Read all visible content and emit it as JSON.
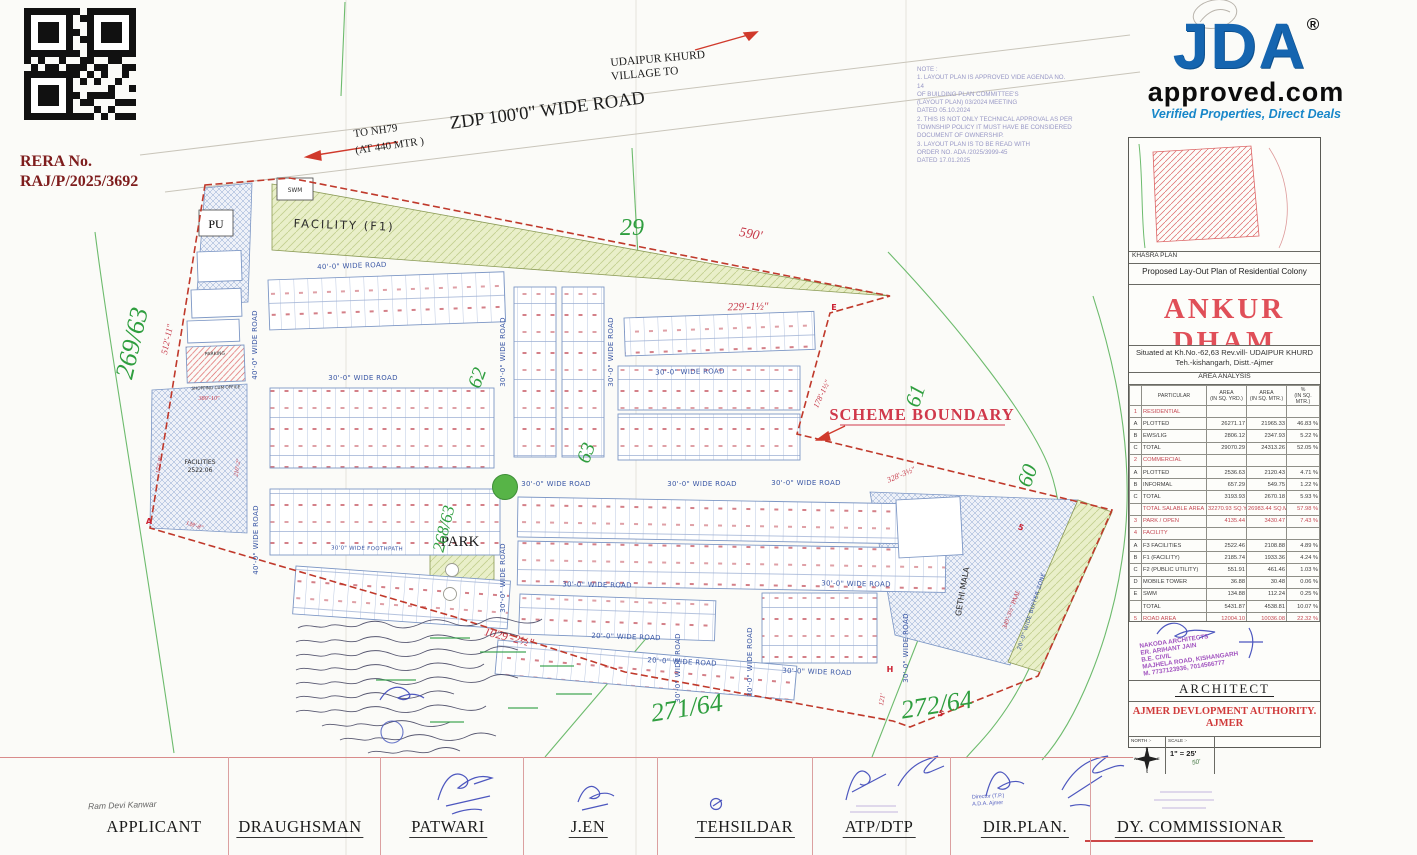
{
  "rera": {
    "label": "RERA No.",
    "number": "RAJ/P/2025/3692"
  },
  "logo": {
    "title": "JDA",
    "registered": "®",
    "domain": "approved.com",
    "tagline": "Verified Properties, Direct Deals",
    "brand_blue": "#1565b0"
  },
  "top_labels": {
    "village_line1": "UDAIPUR KHURD",
    "village_line2": "VILLAGE TO",
    "zdp_road": "ZDP 100'0\" WIDE ROAD",
    "nh79_line1": "TO NH79",
    "nh79_line2": "(AT 440 MTR )"
  },
  "note": {
    "lines": [
      "NOTE :",
      "1. LAYOUT PLAN IS APPROVED VIDE AGENDA NO. 14",
      "OF BUILDING PLAN COMMITTEE'S",
      "(LAYOUT PLAN)   03/2024   MEETING",
      "DATED   05.10.2024",
      "2. THIS IS NOT ONLY TECHNICAL APPROVAL AS PER",
      "TOWNSHIP POLICY IT MUST HAVE BE CONSIDERED",
      "DOCUMENT OF OWNERSHIP.",
      "3. LAYOUT PLAN IS TO BE READ WITH",
      "ORDER NO. ADA /2025/3999-45",
      "DATED   17.01.2025"
    ]
  },
  "plan": {
    "scheme_boundary": "SCHEME BOUNDARY",
    "roads": {
      "r40": "40'-0\" WIDE ROAD",
      "r30": "30'-0\" WIDE ROAD",
      "r20": "20'-0\" WIDE ROAD",
      "buffer": "20'-0\" WIDE BUFFER ZONE",
      "foothpath": "30'0\" WIDE FOOTHPATH"
    },
    "zones": {
      "facility": "FACILITY (F1)",
      "swm": "SWM",
      "pu": "PU",
      "park": "PARK",
      "gethi": "GETHI MALA",
      "facilities1": "FACILITIES",
      "facilities2": "2522.06",
      "parking": "PARKING",
      "shopping": "SHOPPING CUM OFFICE"
    },
    "khasra": {
      "k269_63": "269/63",
      "k29": "29",
      "k62": "62",
      "k63": "63",
      "k61": "61",
      "k60": "60",
      "k268_63": "268/63",
      "k271_64": "271/64",
      "k272_64": "272/64"
    },
    "dims": {
      "d590": "590'",
      "d512": "512'-11\"",
      "d229": "229'-1½\"",
      "d178": "178'-1½\"",
      "d328": "328'-3½\"",
      "d1029": "1029'-2½\"",
      "d121": "121'",
      "d380": "380'-10\"",
      "d172": "172'-8\"",
      "d210": "210'-2\"",
      "d138": "138'-8\"",
      "d349": "349'-3½\" PAAL"
    },
    "markers": {
      "a": "A",
      "e": "E",
      "h": "H",
      "five": "5"
    }
  },
  "panel": {
    "khasra_plan": "KHASRA PLAN",
    "subtitle": "Proposed  Lay-Out Plan of  Residential Colony",
    "title": "ANKUR DHAM",
    "situated1": "Situated at Kh.No.-62,63 Rev.vill- UDAIPUR KHURD",
    "situated2": "Teh.-kishangarh, Distt.-Ajmer",
    "table": {
      "title": "AREA ANALYSIS",
      "headers": {
        "particular": "PARTICULAR",
        "yd": "AREA",
        "yd_sub": "(IN SQ. YRD.)",
        "mt": "AREA",
        "mt_sub": "(IN SQ. MTR.)",
        "pct": "%",
        "pct_sub": "(IN SQ. MTR.)"
      },
      "rows": [
        {
          "sn": "1",
          "name": "RESIDENTIAL",
          "yd": "",
          "mt": "",
          "pct": "",
          "red": true
        },
        {
          "sn": "A",
          "name": "PLOTTED",
          "yd": "26271.17",
          "mt": "21965.33",
          "pct": "46.83 %"
        },
        {
          "sn": "B",
          "name": "EWS/LIG",
          "yd": "2806.12",
          "mt": "2347.93",
          "pct": "5.22 %"
        },
        {
          "sn": "C",
          "name": "TOTAL",
          "yd": "29070.29",
          "mt": "24313.26",
          "pct": "52.05 %"
        },
        {
          "sn": "2",
          "name": "COMMERCIAL",
          "yd": "",
          "mt": "",
          "pct": "",
          "red": true
        },
        {
          "sn": "A",
          "name": "PLOTTED",
          "yd": "2536.63",
          "mt": "2120.43",
          "pct": "4.71 %"
        },
        {
          "sn": "B",
          "name": "INFORMAL",
          "yd": "657.29",
          "mt": "549.75",
          "pct": "1.22 %"
        },
        {
          "sn": "C",
          "name": "TOTAL",
          "yd": "3193.93",
          "mt": "2670.18",
          "pct": "5.93 %"
        },
        {
          "sn": "",
          "name": "TOTAL SALABLE AREA",
          "yd": "32270.93 SQ.YRD",
          "mt": "26983.44 SQ.MT",
          "pct": "57.98 %",
          "red": true
        },
        {
          "sn": "3",
          "name": "PARK / OPEN",
          "yd": "4135.44",
          "mt": "3430.47",
          "pct": "7.43 %",
          "red": true
        },
        {
          "sn": "4",
          "name": "FACILITY",
          "yd": "",
          "mt": "",
          "pct": "",
          "red": true
        },
        {
          "sn": "A",
          "name": "F3 FACILITIES",
          "yd": "2522.46",
          "mt": "2108.88",
          "pct": "4.89 %"
        },
        {
          "sn": "B",
          "name": "F1 (FACILITY)",
          "yd": "2185.74",
          "mt": "1933.36",
          "pct": "4.24 %"
        },
        {
          "sn": "C",
          "name": "F2 (PUBLIC UTILITY)",
          "yd": "551.91",
          "mt": "461.46",
          "pct": "1.03 %"
        },
        {
          "sn": "D",
          "name": "MOBILE TOWER",
          "yd": "36.88",
          "mt": "30.48",
          "pct": "0.06 %"
        },
        {
          "sn": "E",
          "name": "SWM",
          "yd": "134.88",
          "mt": "112.24",
          "pct": "0.25 %"
        },
        {
          "sn": "",
          "name": "TOTAL",
          "yd": "5431.87",
          "mt": "4538.81",
          "pct": "10.07 %"
        },
        {
          "sn": "5",
          "name": "ROAD AREA",
          "yd": "12004.10",
          "mt": "10036.08",
          "pct": "22.32 %",
          "red": true
        },
        {
          "sn": "",
          "name": "TOTAL",
          "yd": "53842.34 SQ.YD",
          "mt": "45019.67 SQ.MT",
          "pct": "100.00 %",
          "red": true
        }
      ]
    },
    "stamp_lines": [
      "NAKODA ARCHITECTS",
      "ER. ARIHANT JAIN",
      "B.E. CIVIL",
      "MAJHELA ROAD, KISHANGARH",
      "M. 7737123936, 7014566777"
    ],
    "architect": "ARCHITECT",
    "authority1": "AJMER DEVLOPMENT AUTHORITY.",
    "authority2": "AJMER",
    "north_label": "NORTH :-",
    "compass": {
      "n": "N",
      "e": "E",
      "s": "S",
      "w": "W"
    },
    "scale_label": "SCALE :-",
    "scale_value": "1\" = 25'",
    "scale_note": "50'"
  },
  "signatures": {
    "applicant_name": "Ram Devi Kanwar",
    "roles": [
      "APPLICANT",
      "DRAUGHSMAN",
      "PATWARI",
      "J.EN",
      "TEHSILDAR",
      "ATP/DTP",
      "DIR.PLAN.",
      "DY. COMMISSIONAR"
    ],
    "dir_stamp1": "Director (T.P.)",
    "dir_stamp2": "A.D.A. Ajmer"
  }
}
